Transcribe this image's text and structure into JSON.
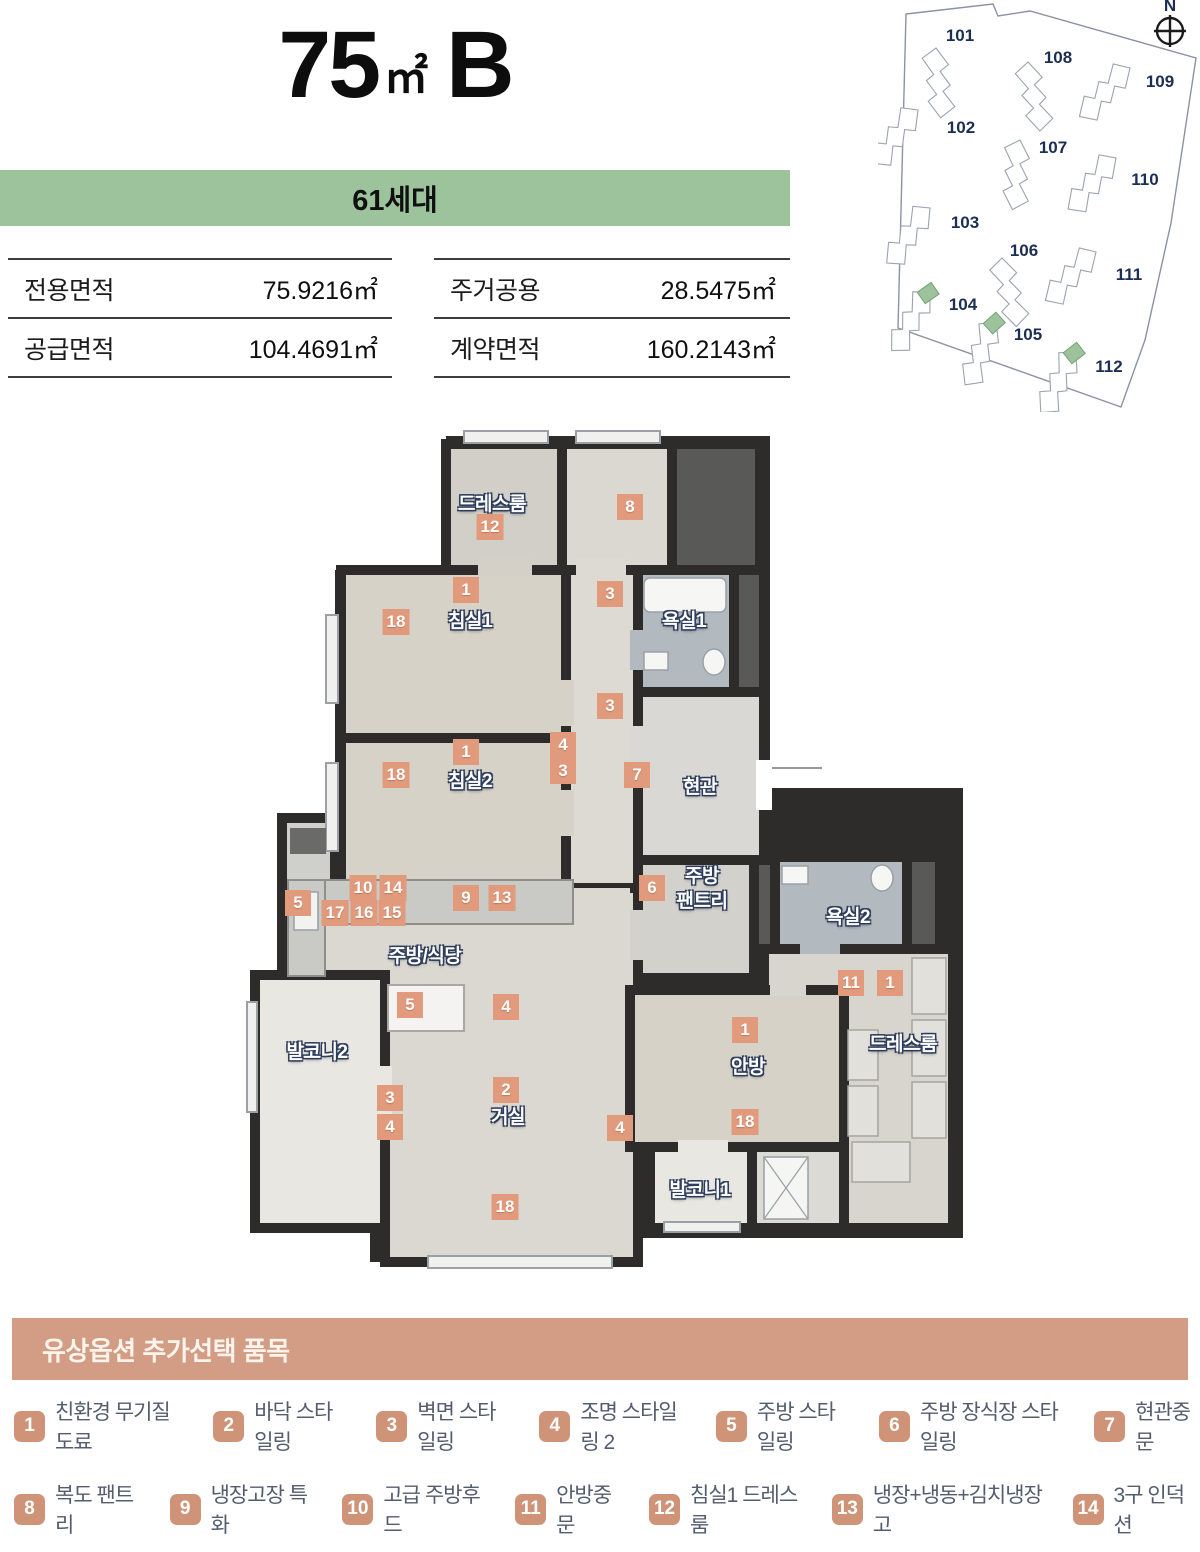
{
  "header": {
    "title_number": "75",
    "title_unit": "㎡",
    "title_type": "B"
  },
  "banner": {
    "units": "61세대"
  },
  "area_table": {
    "left": [
      {
        "label": "전용면적",
        "value": "75.9216㎡"
      },
      {
        "label": "공급면적",
        "value": "104.4691㎡"
      }
    ],
    "right": [
      {
        "label": "주거공용",
        "value": "28.5475㎡"
      },
      {
        "label": "계약면적",
        "value": "160.2143㎡"
      }
    ]
  },
  "site_map": {
    "compass": "N",
    "buildings": [
      {
        "label": "101"
      },
      {
        "label": "108"
      },
      {
        "label": "109"
      },
      {
        "label": "102"
      },
      {
        "label": "107"
      },
      {
        "label": "110"
      },
      {
        "label": "103"
      },
      {
        "label": "106"
      },
      {
        "label": "111"
      },
      {
        "label": "104"
      },
      {
        "label": "105"
      },
      {
        "label": "112"
      }
    ],
    "highlighted": [
      "104",
      "105",
      "112"
    ]
  },
  "floor_plan": {
    "rooms": {
      "dress_top": "드레스룸",
      "bed1": "침실1",
      "bath1": "욕실1",
      "bed2": "침실2",
      "entrance": "현관",
      "pantry_line1": "주방",
      "pantry_line2": "팬트리",
      "kitchen": "주방/식당",
      "balcony2": "발코니2",
      "living": "거실",
      "bath2": "욕실2",
      "master": "안방",
      "dress_right": "드레스룸",
      "balcony1": "발코니1"
    },
    "markers": [
      "12",
      "8",
      "1",
      "18",
      "3",
      "3",
      "1",
      "18",
      "4",
      "3",
      "7",
      "6",
      "10",
      "14",
      "17",
      "16",
      "15",
      "9",
      "13",
      "5",
      "5",
      "4",
      "3",
      "4",
      "2",
      "4",
      "11",
      "1",
      "1",
      "18",
      "18"
    ]
  },
  "legend": {
    "title": "유상옵션 추가선택 품목",
    "rows": [
      [
        {
          "num": "1",
          "label": "친환경 무기질 도료"
        },
        {
          "num": "2",
          "label": "바닥 스타일링"
        },
        {
          "num": "3",
          "label": "벽면 스타일링"
        },
        {
          "num": "4",
          "label": "조명 스타일링 2"
        },
        {
          "num": "5",
          "label": "주방 스타일링"
        },
        {
          "num": "6",
          "label": "주방 장식장 스타일링"
        },
        {
          "num": "7",
          "label": "현관중문"
        }
      ],
      [
        {
          "num": "8",
          "label": "복도 팬트리"
        },
        {
          "num": "9",
          "label": "냉장고장 특화"
        },
        {
          "num": "10",
          "label": "고급 주방후드"
        },
        {
          "num": "11",
          "label": "안방중문"
        },
        {
          "num": "12",
          "label": "침실1 드레스룸"
        },
        {
          "num": "13",
          "label": "냉장+냉동+김치냉장고"
        },
        {
          "num": "14",
          "label": "3구 인덕션"
        }
      ],
      [
        {
          "num": "15",
          "label": "3구 하이브리드"
        },
        {
          "num": "16",
          "label": "전기오븐"
        },
        {
          "num": "17",
          "label": "식기세척기"
        },
        {
          "num": "18",
          "label": "시스템에어컨"
        }
      ]
    ]
  },
  "colors": {
    "accent": "#d29c85",
    "marker": "#e29a7d",
    "banner_green": "#9cc39c",
    "navy": "#1c2f52"
  }
}
